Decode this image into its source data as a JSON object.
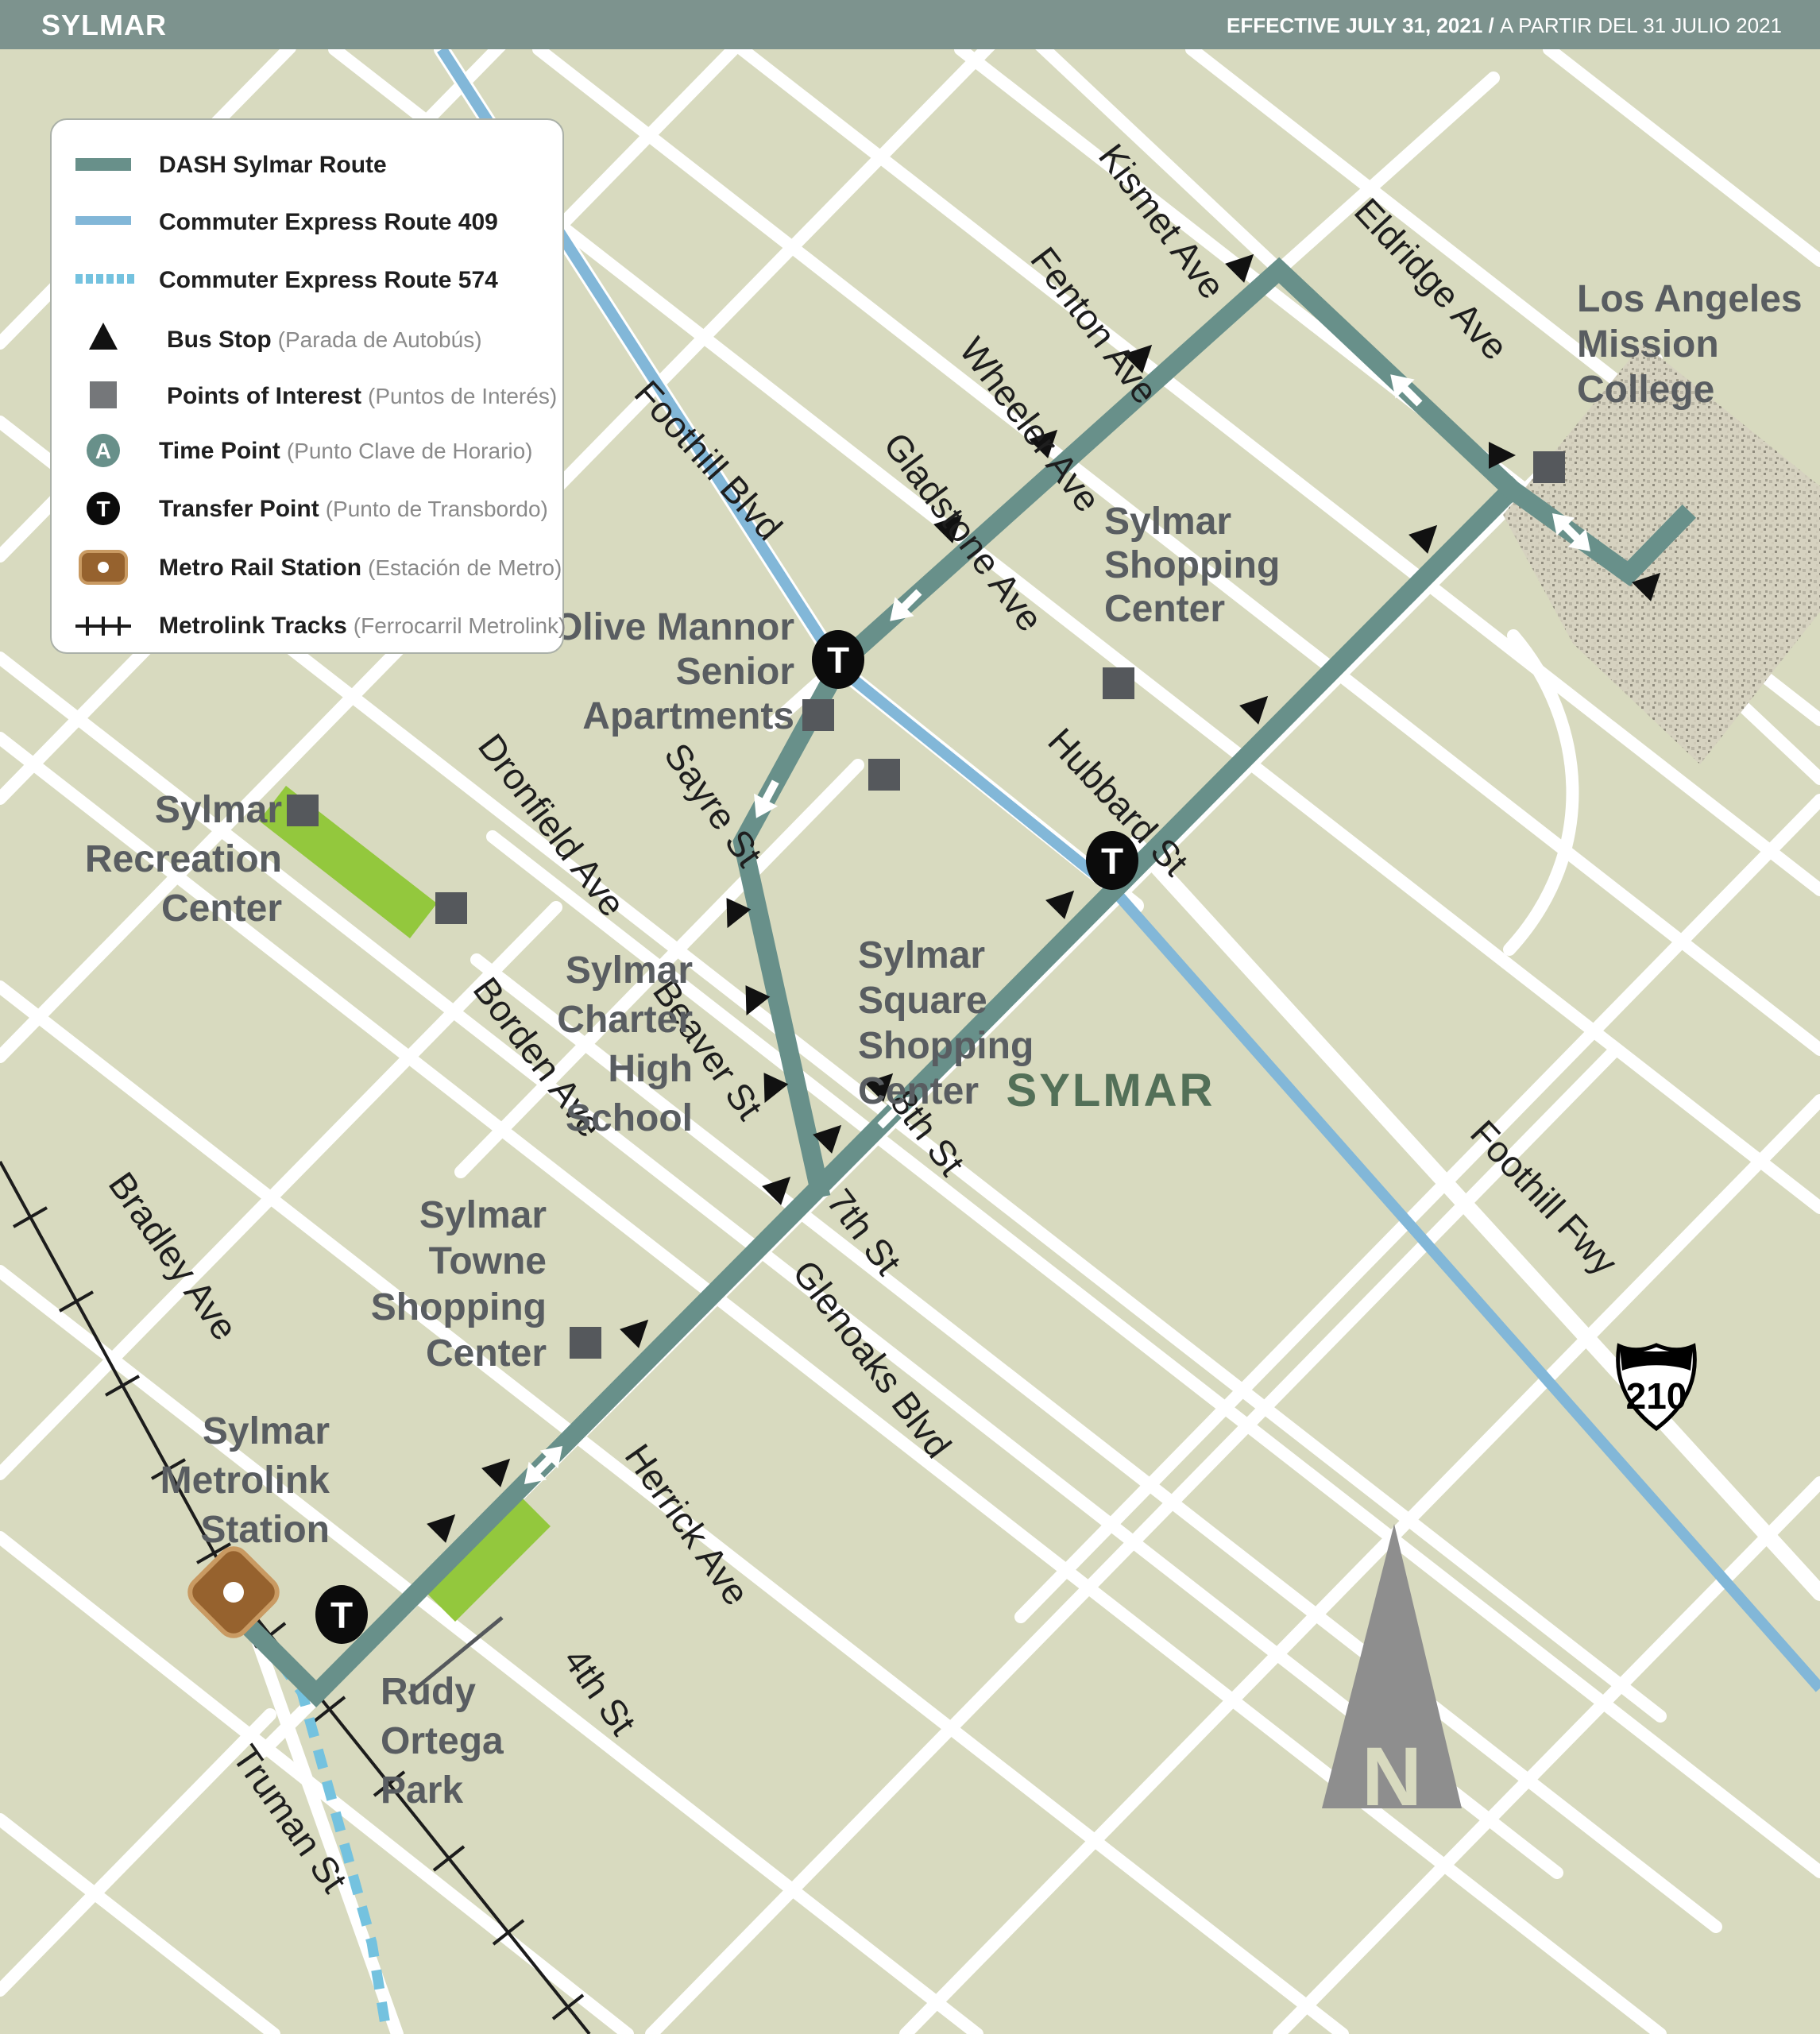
{
  "header": {
    "title": "SYLMAR",
    "effective_bold": "EFFECTIVE JULY 31, 2021 / ",
    "effective_regular": "A PARTIR DEL 31 JULIO 2021"
  },
  "legend": {
    "items": [
      {
        "label": "DASH Sylmar Route",
        "note": ""
      },
      {
        "label": "Commuter Express Route 409",
        "note": ""
      },
      {
        "label": "Commuter Express Route 574",
        "note": ""
      },
      {
        "label": "Bus Stop",
        "note": "(Parada de Autobús)"
      },
      {
        "label": "Points of Interest",
        "note": "(Puntos de Interés)"
      },
      {
        "label": "Time Point",
        "note": "(Punto Clave de Horario)"
      },
      {
        "label": "Transfer Point",
        "note": "(Punto de Transbordo)"
      },
      {
        "label": "Metro Rail Station",
        "note": "(Estación de Metro)"
      },
      {
        "label": "Metrolink Tracks",
        "note": "(Ferrocarril Metrolink)"
      }
    ],
    "time_letter": "A",
    "transfer_letter": "T"
  },
  "map": {
    "region_label": "SYLMAR",
    "shield_number": "210",
    "north_letter": "N",
    "transfer_letter": "T",
    "streets": [
      {
        "label": "Kismet Ave"
      },
      {
        "label": "Fenton Ave"
      },
      {
        "label": "Wheeler Ave"
      },
      {
        "label": "Gladstone Ave"
      },
      {
        "label": "Eldridge Ave"
      },
      {
        "label": "Foothill Blvd"
      },
      {
        "label": "Sayre St"
      },
      {
        "label": "Beaver St"
      },
      {
        "label": "Hubbard St"
      },
      {
        "label": "Dronfield Ave"
      },
      {
        "label": "Borden Ave"
      },
      {
        "label": "8th St"
      },
      {
        "label": "7th St"
      },
      {
        "label": "Glenoaks Blvd"
      },
      {
        "label": "Herrick Ave"
      },
      {
        "label": "4th St"
      },
      {
        "label": "Bradley Ave"
      },
      {
        "label": "Truman St"
      },
      {
        "label": "Foothill Fwy"
      }
    ],
    "pois": {
      "college": {
        "lines": [
          "Los Angeles",
          "Mission",
          "College"
        ]
      },
      "shopping": {
        "lines": [
          "Sylmar",
          "Shopping",
          "Center"
        ]
      },
      "olive": {
        "lines": [
          "Olive Mannor",
          "Senior",
          "Apartments"
        ]
      },
      "square": {
        "lines": [
          "Sylmar",
          "Square",
          "Shopping",
          "Center"
        ]
      },
      "rec": {
        "lines": [
          "Sylmar",
          "Recreation",
          "Center"
        ]
      },
      "charter": {
        "lines": [
          "Sylmar",
          "Charter",
          "High",
          "School"
        ]
      },
      "towne": {
        "lines": [
          "Sylmar",
          "Towne",
          "Shopping",
          "Center"
        ]
      },
      "metrolink": {
        "lines": [
          "Sylmar",
          "Metrolink",
          "Station"
        ]
      },
      "ortega": {
        "lines": [
          "Rudy",
          "Ortega",
          "Park"
        ]
      }
    }
  },
  "colors": {
    "header_bg": "#7d938e",
    "map_bg": "#d8dabf",
    "dash_route": "#68908a",
    "route_409": "#82b7d8",
    "route_574": "#74c2df",
    "park_green": "#93c83d",
    "poi_gray": "#55585c",
    "metro_brown": "#96622e",
    "region_text": "#537058"
  }
}
